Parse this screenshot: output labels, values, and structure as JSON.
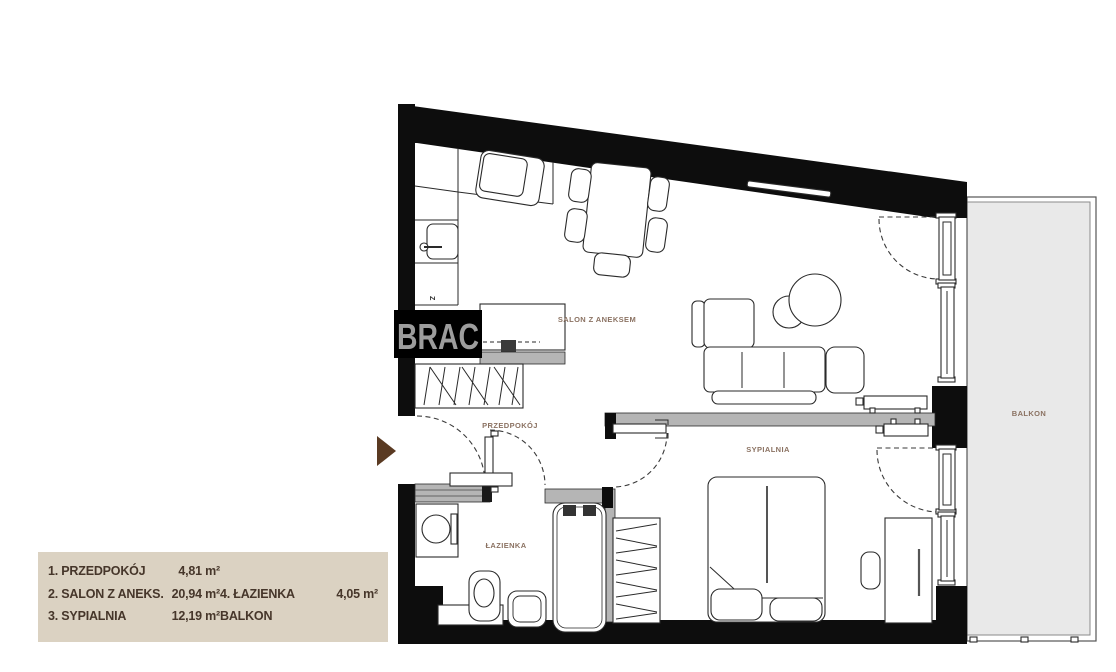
{
  "floorplan": {
    "watermark": "BRAC",
    "rooms": {
      "salon": "SALON Z ANEKSEM",
      "przedpokoj": "PRZEDPOKÓJ",
      "lazienka": "ŁAZIENKA",
      "sypialnia": "SYPIALNIA",
      "balkon": "BALKON"
    },
    "markers": {
      "kitchen_unit": "Z"
    },
    "colors": {
      "wall": "#0d0d0d",
      "partition": "#b5b5b5",
      "balcony_fill": "#e9e9e9",
      "room_label": "#8b7262",
      "entrance_arrow": "#5a3a22",
      "legend_background": "#dbd2c2",
      "legend_text": "#46362a",
      "watermark_text": "#9d9d9d"
    }
  },
  "legend": {
    "rows": [
      {
        "label": "1. PRZEDPOKÓJ",
        "value": "4,81 m²",
        "label2": "",
        "value2": ""
      },
      {
        "label": "2. SALON Z ANEKS.",
        "value": "20,94 m²",
        "label2": "4. ŁAZIENKA",
        "value2": "4,05 m²"
      },
      {
        "label": "3. SYPIALNIA",
        "value": "12,19 m²",
        "label2": "BALKON",
        "value2": ""
      }
    ]
  }
}
